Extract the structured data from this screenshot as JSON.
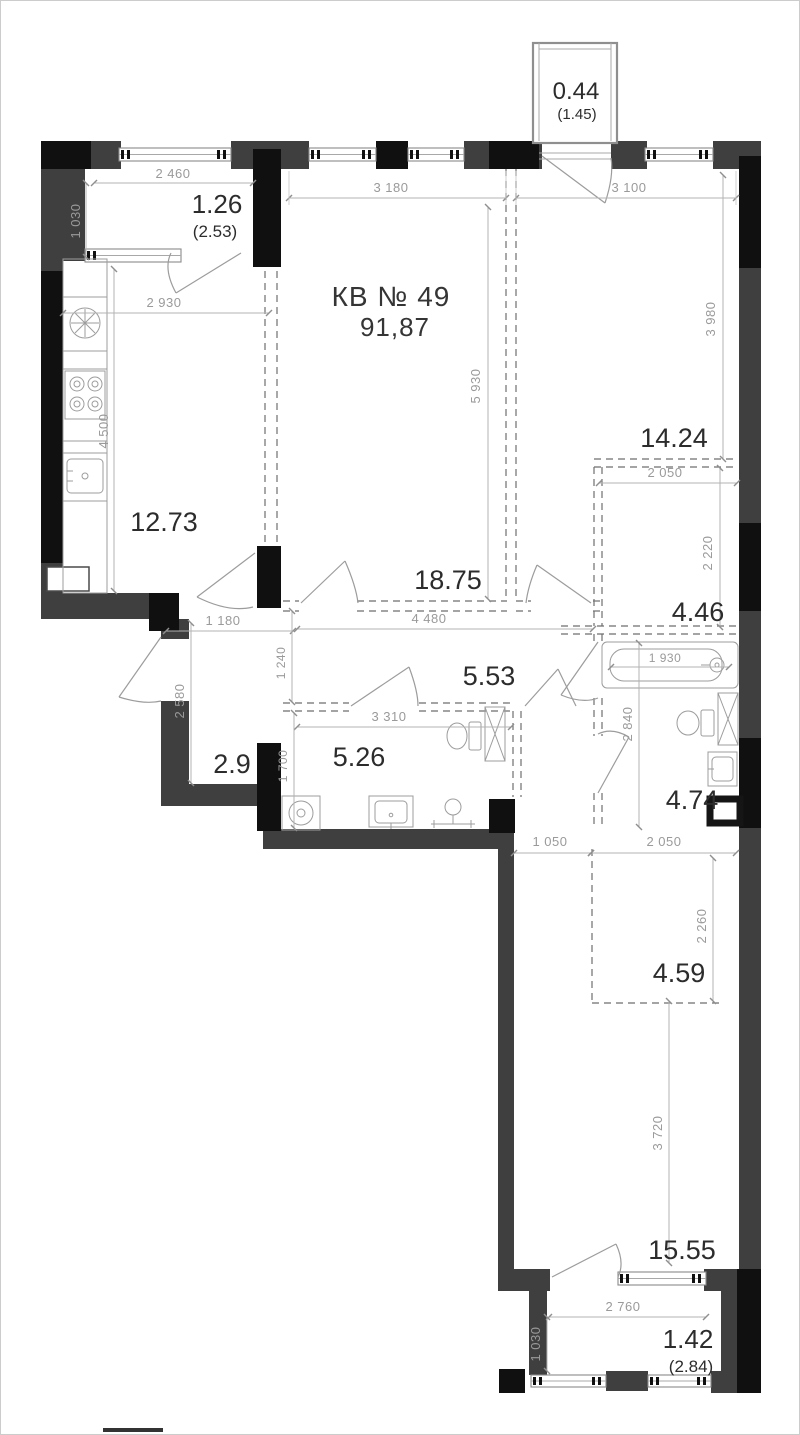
{
  "plan": {
    "title": "КВ № 49",
    "total_area": "91,87",
    "rooms": {
      "kitchen": "12.73",
      "living": "18.75",
      "bedroom_right": "14.24",
      "bath_top": "4.46",
      "hall": "5.53",
      "bath_left": "5.26",
      "entry": "2.9",
      "bath_bottom": "4.74",
      "wardrobe": "4.59",
      "bedroom_bottom": "15.55"
    },
    "balconies": {
      "top": {
        "reduced": "0.44",
        "full": "(1.45)"
      },
      "left": {
        "reduced": "1.26",
        "full": "(2.53)"
      },
      "bottom": {
        "reduced": "1.42",
        "full": "(2.84)"
      }
    },
    "dims": {
      "balcony_left_w": "2 460",
      "balcony_left_h": "1 030",
      "living_w": "3 180",
      "bedroom_right_w": "3 100",
      "bedroom_right_h": "3 980",
      "kitchen_w": "2 930",
      "kitchen_h": "4 500",
      "living_h": "5 930",
      "zone_right_w": "2 050",
      "zone_right_h": "2 220",
      "tub_w": "1 930",
      "bath_h": "2 840",
      "entry_w": "1 180",
      "entry_h": "2 580",
      "hall_left_h": "1 240",
      "hall_w": "4 480",
      "bath_left_w": "3 310",
      "bath_left_h": "1 700",
      "below_bath_w1": "1 050",
      "below_bath_w2": "2 050",
      "wardrobe_h": "2 260",
      "bedroom_bottom_h": "3 720",
      "balcony_bottom_w": "2 760",
      "balcony_bottom_h": "1 030"
    }
  }
}
